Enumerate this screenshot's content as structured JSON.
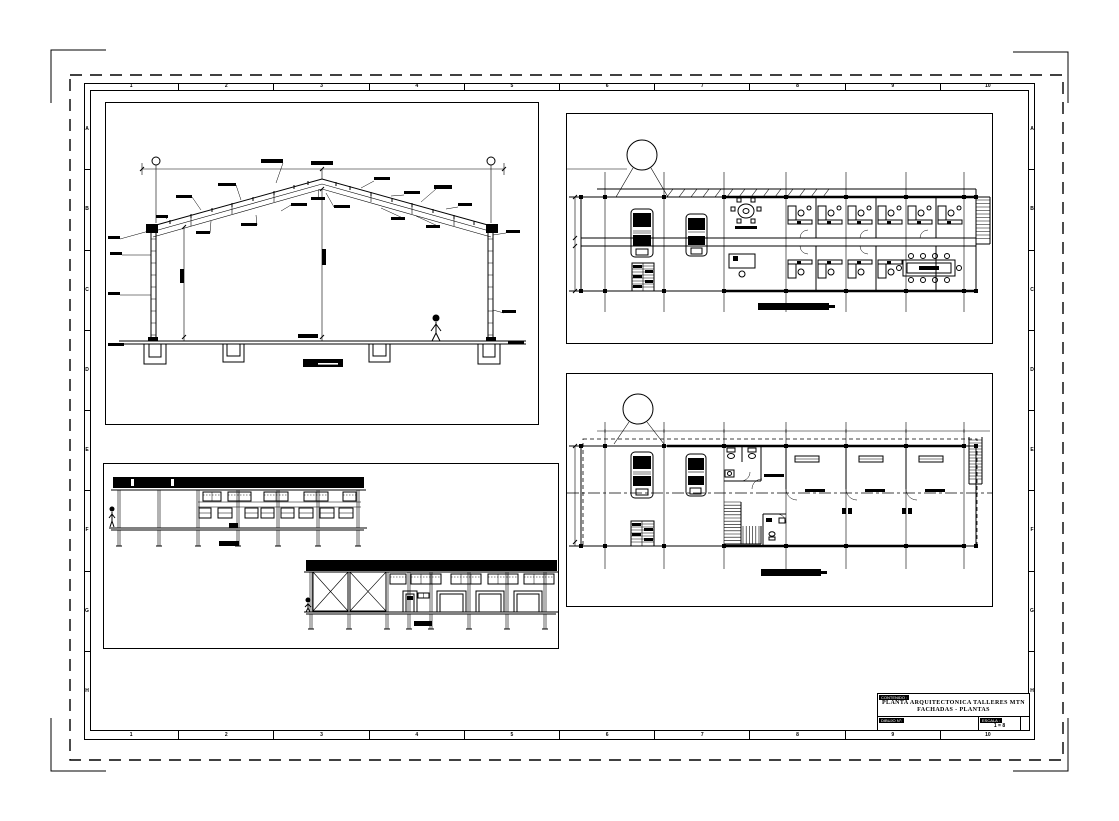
{
  "colors": {
    "ink": "#000000",
    "paper": "#ffffff"
  },
  "sheet": {
    "grid_cols": [
      "1",
      "2",
      "3",
      "4",
      "5",
      "6",
      "7",
      "8",
      "9",
      "10"
    ],
    "grid_rows": [
      "A",
      "B",
      "C",
      "D",
      "E",
      "F",
      "G",
      "H"
    ]
  },
  "title_block": {
    "contenido_label": "CONTENIDO :",
    "title_line1": "PLANTA ARQUITECTONICA TALLERES MTN",
    "title_line2": "FACHADAS - PLANTAS",
    "dibujo_label": "DIBUJO N°:",
    "escala_label": "ESCALA :",
    "escala_value": "1 = 8"
  }
}
